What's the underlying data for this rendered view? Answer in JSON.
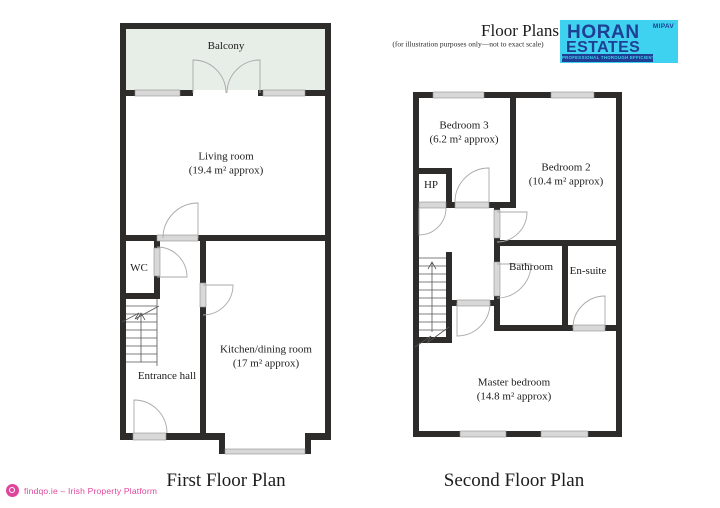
{
  "header": {
    "title": "Floor Plans",
    "subtitle": "(for illustration purposes only—not to exact scale)",
    "logo": {
      "name_line1": "HORAN",
      "name_line2": "ESTATES",
      "badge": "MIPAV",
      "tagline": "PROFESSIONAL THOROUGH EFFICIENT"
    }
  },
  "first_floor": {
    "caption": "First Floor Plan",
    "rooms": {
      "balcony": {
        "name": "Balcony"
      },
      "living_room": {
        "name": "Living room",
        "area": "(19.4 m² approx)"
      },
      "wc": {
        "name": "WC"
      },
      "entrance_hall": {
        "name": "Entrance hall"
      },
      "kitchen": {
        "name": "Kitchen/dining room",
        "area": "(17 m² approx)"
      }
    }
  },
  "second_floor": {
    "caption": "Second Floor Plan",
    "rooms": {
      "bedroom3": {
        "name": "Bedroom 3",
        "area": "(6.2 m² approx)"
      },
      "bedroom2": {
        "name": "Bedroom 2",
        "area": "(10.4 m² approx)"
      },
      "hp": {
        "name": "HP"
      },
      "bathroom": {
        "name": "Bathroom"
      },
      "ensuite": {
        "name": "En-suite"
      },
      "master_bedroom": {
        "name": "Master bedroom",
        "area": "(14.8 m² approx)"
      }
    }
  },
  "footer": {
    "brand": "findqo.ie – Irish Property Platform"
  },
  "colors": {
    "wall": "#2e2c2b",
    "window": "#d8d8d8",
    "balcony_fill": "#e7ede7",
    "arc": "#a9a9a9",
    "stair": "#555555",
    "logo_bg": "#3ed1f0",
    "logo_text": "#1e3f94",
    "accent": "#e0459c"
  }
}
